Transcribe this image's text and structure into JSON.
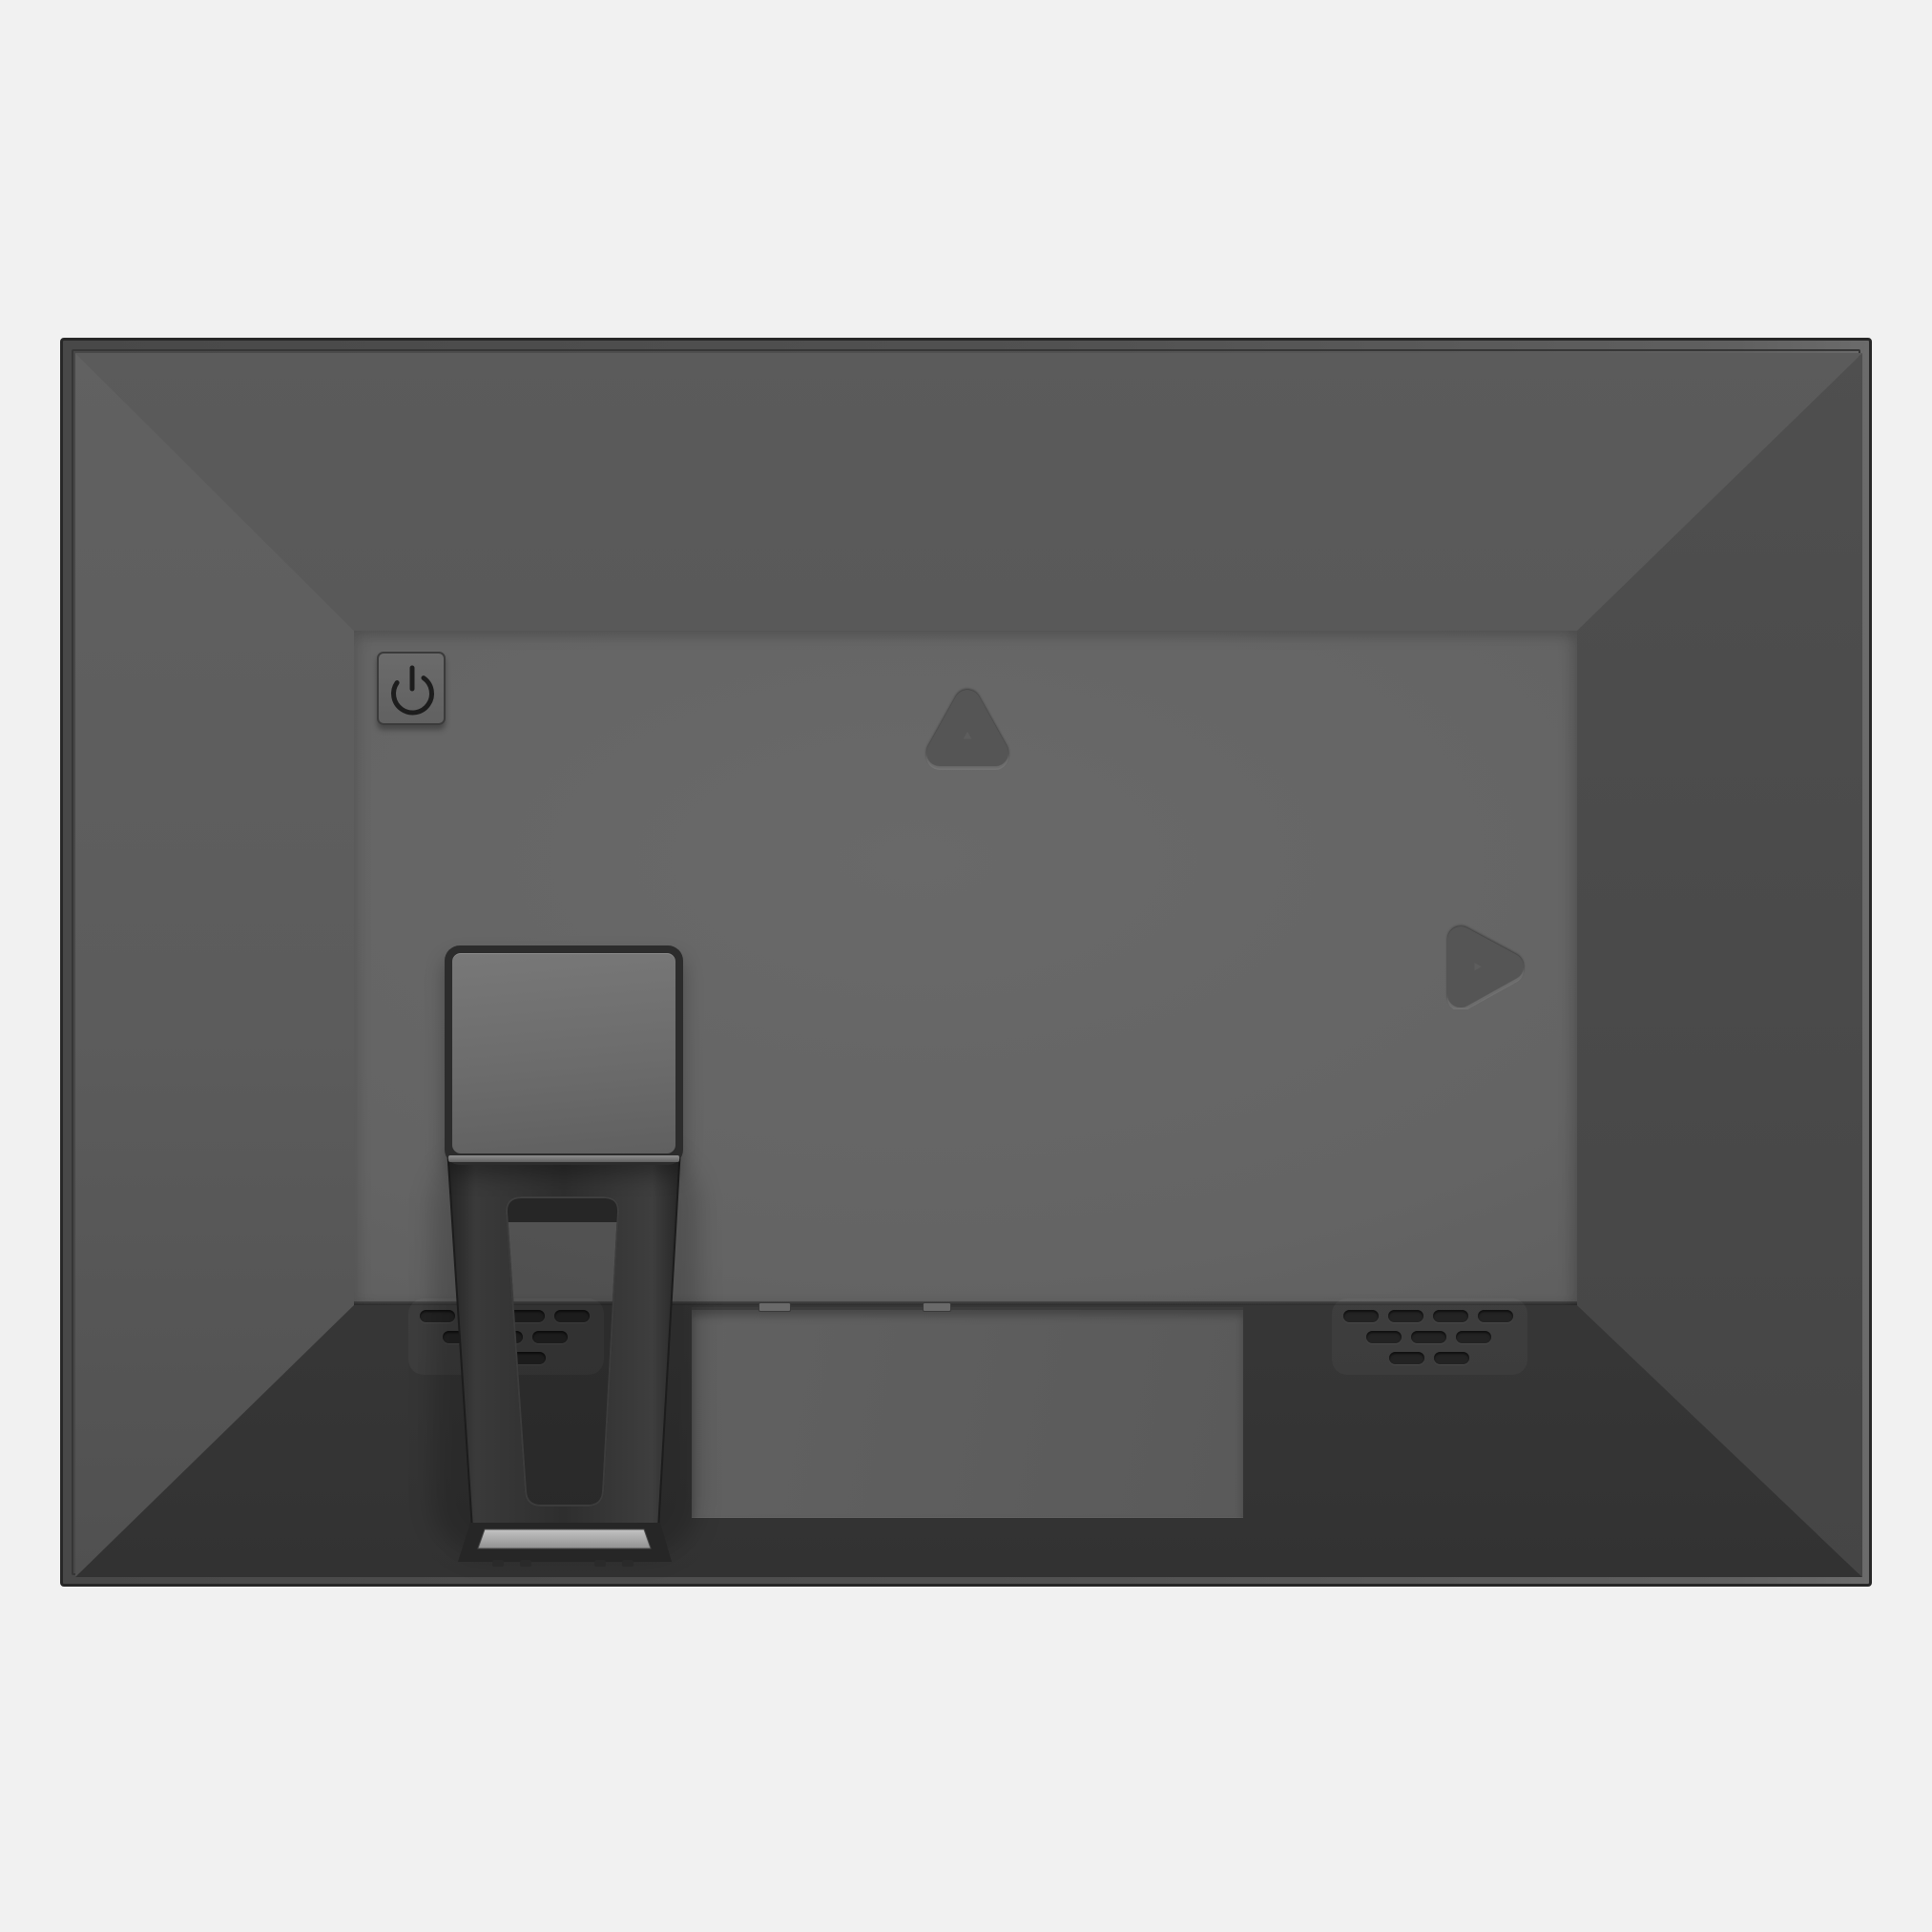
{
  "scene": {
    "type": "product-render",
    "subject": "Rear view of a flat-panel display / digital photo frame with desktop stand",
    "background_color": "#f1f1f1"
  },
  "device": {
    "shape": "beveled rear shell with flat back panel",
    "palette": {
      "frame_edge": "#272727",
      "frame_rim": "#515151",
      "top_face": "#565656",
      "left_face": "#5d5d5d",
      "right_face": "#4b4b4b",
      "bottom_face": "#3a3a3a",
      "back_panel": "#646464",
      "recess_panel": "#5e5e5e",
      "stand_dark": "#2f2f2f",
      "stand_plate_face": "#6e6e6e",
      "foot_highlight": "#b5b5b5",
      "vent_hole": "#232323",
      "glyph": "#1d1d1d"
    }
  },
  "controls": {
    "power_button": {
      "icon": "power-icon",
      "symbol": "⏻",
      "label": "Power"
    }
  },
  "features": {
    "wall_mount_hole": {
      "shape": "rounded-triangle-up"
    },
    "nav_marker": {
      "shape": "rounded-triangle-right"
    },
    "connector_recess": {
      "shape": "rectangle",
      "latch_slots": 2
    },
    "stand": {
      "parts": [
        "mount-plate",
        "arm",
        "slot-cutout",
        "foot",
        "foot-pads"
      ]
    },
    "vents": {
      "clusters": [
        {
          "side": "left",
          "rows": [
            4,
            3,
            2
          ]
        },
        {
          "side": "right",
          "rows": [
            4,
            3,
            2
          ]
        }
      ]
    }
  }
}
